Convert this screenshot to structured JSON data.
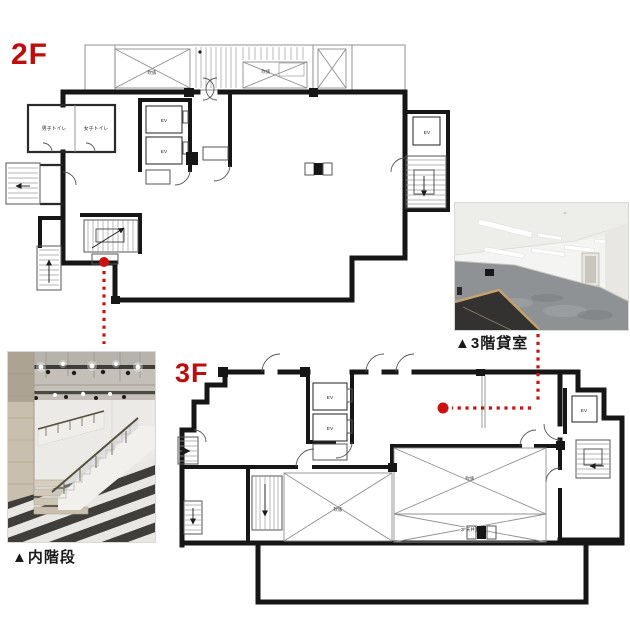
{
  "page": {
    "background": "#ffffff"
  },
  "colors": {
    "floor_label_red": "#bd0d0d",
    "connector_red": "#cc1111",
    "wall_black": "#161616",
    "carpet_gray": "#8f9294"
  },
  "floor_2f": {
    "label": "2F",
    "atrium": "吹抜",
    "mens_toilet": "男子トイレ",
    "womens_toilet": "女子トイレ",
    "elevator": "EV"
  },
  "floor_3f": {
    "label": "3F",
    "atrium": "吹抜",
    "above_2f_ceiling": "2F天井上",
    "elevator": "EV"
  },
  "photos": {
    "inner_stair": {
      "caption": "▲内階段"
    },
    "rental_room": {
      "caption": "▲3階貸室"
    }
  }
}
